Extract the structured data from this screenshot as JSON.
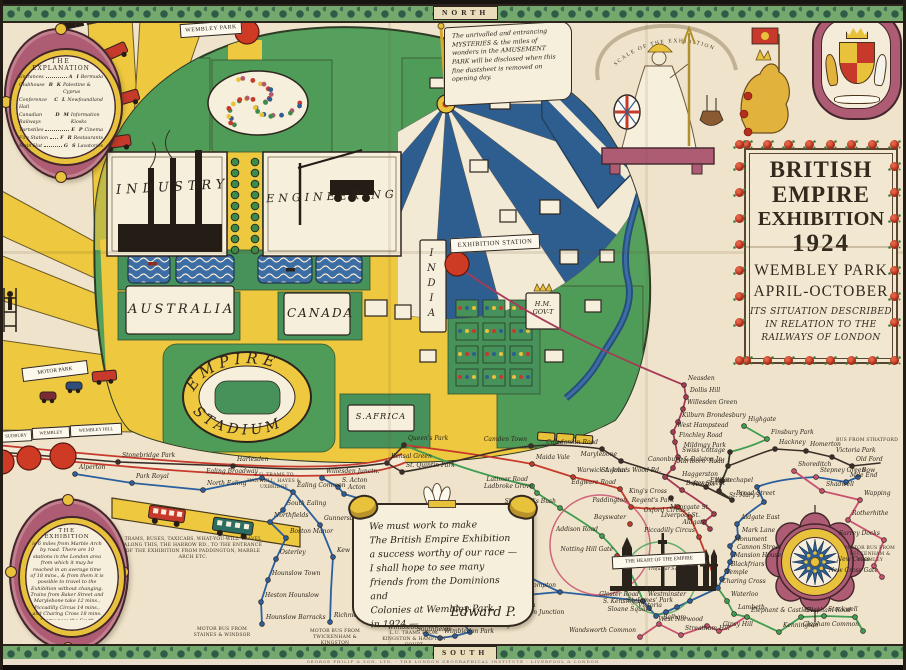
{
  "frame": {
    "north": "NORTH",
    "south": "SOUTH",
    "imprint": "GEORGE PHILIP & SON, LTD. - THE LONDON GEOGRAPHICAL INSTITUTE - LIVERPOOL & LONDON"
  },
  "title_panel": {
    "lines": [
      "BRITISH",
      "EMPIRE",
      "EXHIBITION",
      "1924",
      "WEMBLEY PARK",
      "APRIL-OCTOBER",
      "ITS SITUATION DESCRIBED",
      "IN RELATION TO THE",
      "RAILWAYS OF LONDON"
    ]
  },
  "legend": {
    "title_line1": "THE",
    "title_line2": "EXPLANATION",
    "left": [
      {
        "label": "Entrances",
        "key": "A"
      },
      {
        "label": "Clubhouse",
        "key": "B"
      },
      {
        "label": "Conference Hall",
        "key": "C"
      },
      {
        "label": "Canadian Railways",
        "key": "D"
      },
      {
        "label": "Turnstiles",
        "key": "E"
      },
      {
        "label": "Fire Station",
        "key": "F"
      },
      {
        "label": "Main Hut",
        "key": "G"
      },
      {
        "label": "Bank",
        "key": "H"
      }
    ],
    "right": [
      {
        "key": "I",
        "label": "Bermuda"
      },
      {
        "key": "K",
        "label": "Palestine & Cyprus"
      },
      {
        "key": "L",
        "label": "Newfoundland"
      },
      {
        "key": "M",
        "label": "Information Kiosks"
      },
      {
        "key": "P",
        "label": "Cinema"
      },
      {
        "key": "R",
        "label": "Restaurants"
      },
      {
        "key": "S",
        "label": "Lavatories"
      },
      {
        "key": "T",
        "label": "Sierra Leone"
      }
    ]
  },
  "park": {
    "wembley_park_banner": "WEMBLEY PARK",
    "industry": "INDUSTRY",
    "engineering": "ENGINEERING",
    "australia": "AUSTRALIA",
    "canada": "CANADA",
    "india": "INDIA",
    "s_africa": "S.AFRICA",
    "hm_govt_1": "H.M.",
    "hm_govt_2": "GOV-T",
    "stadium_top": "EMPIRE",
    "stadium_bottom": "STADIUM",
    "exhibition_station_banner": "EXHIBITION STATION"
  },
  "banners": {
    "scale_ribbon": "SCALE OF THE EXHIBITION",
    "motor_park": "MOTOR PARK",
    "sudbury": "SUDBURY",
    "wembley": "WEMBLEY",
    "wembley_hill": "WEMBLEY HILL",
    "heart_of_empire": "THE HEART OF THE EMPIRE",
    "trafalgar": "Trafalgar Square"
  },
  "scroll_amusement": "The unrivalled and entrancing MYSTERIES & the miles of wonders in the AMUSEMENT PARK will be disclosed when this fine dustsheet is removed on opening day.",
  "scroll_king": {
    "lines": [
      "We must work to make",
      "The British Empire Exhibition",
      "a success worthy of our race —",
      "I shall hope to see many",
      "friends from the Dominions and",
      "Colonies at Wembley Park",
      "in 1924 —"
    ],
    "signature": "Edward P."
  },
  "cartouche_exhibition": {
    "title_line1": "THE",
    "title_line2": "EXHIBITION",
    "text": "is 6 miles from Marble Arch by road. There are 10 stations in the London area from which it may be reached in an average time of 18 mins., & from them it is possible to travel to the Exhibition without changing. Trains from Baker Street and Marylebone take 12 mins., Piccadilly Circus 14 mins., and Charing Cross 18 mins. Trams pass the South Entrance from Paddington, Willesden, Hammersmith, Putney, Acton &c. Omnibus services run to all the entrances."
  },
  "notes": [
    {
      "t": "L.U. TRAMS TO HANWELL, HAYES & UXBRIDGE",
      "x": 243,
      "y": 473,
      "w": 62
    },
    {
      "t": "TRAMS, BUSES, TAXICABS, WHAT-YOU-WILL TRAVEL ALONG THIS, THE HARROW RD., TO THE ENTRANCE OF THE EXHIBITION FROM PADDINGTON, MARBLE ARCH ETC.",
      "x": 122,
      "y": 537,
      "w": 142
    },
    {
      "t": "MOTOR BUS FROM STAINES & WINDSOR",
      "x": 192,
      "y": 627,
      "w": 60
    },
    {
      "t": "MOTOR BUS FROM TWICKENHAM & KINGSTON",
      "x": 303,
      "y": 629,
      "w": 64
    },
    {
      "t": "L.U. TRAMS FROM KINGSTON & HAMPTON COURT",
      "x": 380,
      "y": 631,
      "w": 68
    },
    {
      "t": "MOTOR BUS FROM BECKENHAM & BROMLEY",
      "x": 840,
      "y": 546,
      "w": 60
    },
    {
      "t": "BUS FROM STRATFORD",
      "x": 836,
      "y": 438,
      "w": 62
    }
  ],
  "stations": [
    {
      "n": "Alperton",
      "x": 75,
      "y": 474,
      "c": "blue"
    },
    {
      "n": "Park Royal",
      "x": 132,
      "y": 483,
      "c": "blue"
    },
    {
      "n": "North Ealing",
      "x": 203,
      "y": 490,
      "c": "blue"
    },
    {
      "n": "Ealing Broadway",
      "x": 262,
      "y": 478,
      "c": "blue",
      "a": "e"
    },
    {
      "n": "Ealing Common",
      "x": 293,
      "y": 492,
      "c": "blue"
    },
    {
      "n": "South Ealing",
      "x": 283,
      "y": 510,
      "c": "blue"
    },
    {
      "n": "Northfields",
      "x": 270,
      "y": 522,
      "c": "blue"
    },
    {
      "n": "Boston Manor",
      "x": 286,
      "y": 538,
      "c": "blue"
    },
    {
      "n": "Osterley",
      "x": 276,
      "y": 559,
      "c": "blue"
    },
    {
      "n": "Hounslow Town",
      "x": 268,
      "y": 580,
      "c": "blue"
    },
    {
      "n": "Heston Hounslow",
      "x": 261,
      "y": 602,
      "c": "blue"
    },
    {
      "n": "Hounslow Barracks",
      "x": 262,
      "y": 624,
      "c": "blue"
    },
    {
      "n": "Gunnersbury",
      "x": 320,
      "y": 525,
      "c": "blue"
    },
    {
      "n": "Kew Gardens",
      "x": 333,
      "y": 557,
      "c": "blue"
    },
    {
      "n": "Richmond",
      "x": 330,
      "y": 622,
      "c": "blue"
    },
    {
      "n": "Willesden Junctn.",
      "x": 322,
      "y": 478,
      "c": "blue"
    },
    {
      "n": "S. Acton",
      "x": 338,
      "y": 487,
      "c": "blue"
    },
    {
      "n": "Acton",
      "x": 344,
      "y": 494,
      "c": "blue"
    },
    {
      "n": "Stonebridge Park",
      "x": 118,
      "y": 462,
      "c": "dark"
    },
    {
      "n": "Harlesden",
      "x": 233,
      "y": 466,
      "c": "dark"
    },
    {
      "n": "Kensal Green",
      "x": 387,
      "y": 463,
      "c": "dark"
    },
    {
      "n": "Queen's Park",
      "x": 404,
      "y": 445,
      "c": "dark"
    },
    {
      "n": "St. Quintin Park",
      "x": 402,
      "y": 472,
      "c": "dark"
    },
    {
      "n": "Maida Vale",
      "x": 532,
      "y": 464,
      "c": "red"
    },
    {
      "n": "Warwick Avenue",
      "x": 573,
      "y": 477,
      "c": "red"
    },
    {
      "n": "Paddington",
      "x": 631,
      "y": 507,
      "c": "red",
      "a": "e"
    },
    {
      "n": "Edgware Road",
      "x": 620,
      "y": 489,
      "c": "red",
      "a": "e"
    },
    {
      "n": "Marylebone",
      "x": 621,
      "y": 461,
      "c": "dark",
      "a": "e"
    },
    {
      "n": "Caledonian Road",
      "x": 602,
      "y": 449,
      "c": "dark",
      "a": "e"
    },
    {
      "n": "Camden Town",
      "x": 531,
      "y": 446,
      "c": "dark",
      "a": "e"
    },
    {
      "n": "Latimer Road",
      "x": 532,
      "y": 486,
      "c": "green",
      "a": "e"
    },
    {
      "n": "Ladbroke Grove",
      "x": 537,
      "y": 493,
      "c": "green",
      "a": "e"
    },
    {
      "n": "Shepherd's Bush",
      "x": 560,
      "y": 508,
      "c": "green",
      "a": "e"
    },
    {
      "n": "Addison Road",
      "x": 602,
      "y": 536,
      "c": "green",
      "a": "e"
    },
    {
      "n": "Notting Hill Gate",
      "x": 617,
      "y": 556,
      "c": "red",
      "a": "e"
    },
    {
      "n": "Bayswater",
      "x": 630,
      "y": 524,
      "c": "red",
      "a": "e"
    },
    {
      "n": "Neasden",
      "x": 684,
      "y": 385,
      "c": "maroon"
    },
    {
      "n": "Dollis Hill",
      "x": 686,
      "y": 397,
      "c": "maroon"
    },
    {
      "n": "Willesden Green",
      "x": 683,
      "y": 409,
      "c": "maroon"
    },
    {
      "n": "Kilburn Brondesbury",
      "x": 678,
      "y": 422,
      "c": "maroon"
    },
    {
      "n": "West Hampstead",
      "x": 673,
      "y": 432,
      "c": "maroon"
    },
    {
      "n": "Finchley Road",
      "x": 675,
      "y": 442,
      "c": "maroon"
    },
    {
      "n": "Swiss Cottage",
      "x": 678,
      "y": 457,
      "c": "maroon"
    },
    {
      "n": "Marlboro' Road",
      "x": 673,
      "y": 468,
      "c": "maroon"
    },
    {
      "n": "St. John's Wood Rd.",
      "x": 665,
      "y": 477,
      "c": "maroon",
      "a": "e"
    },
    {
      "n": "Baker Street",
      "x": 682,
      "y": 490,
      "c": "maroon"
    },
    {
      "n": "King's Cross",
      "x": 671,
      "y": 498,
      "c": "dark",
      "a": "e"
    },
    {
      "n": "Euston",
      "x": 706,
      "y": 487,
      "c": "dark"
    },
    {
      "n": "Regent's Park",
      "x": 678,
      "y": 507,
      "c": "red",
      "a": "e"
    },
    {
      "n": "Oxford Circus",
      "x": 690,
      "y": 517,
      "c": "red",
      "a": "e"
    },
    {
      "n": "Piccadilly Circus",
      "x": 699,
      "y": 537,
      "c": "red",
      "a": "e"
    },
    {
      "n": "Highgate",
      "x": 744,
      "y": 426,
      "c": "green"
    },
    {
      "n": "Finsbury Park",
      "x": 767,
      "y": 439,
      "c": "green"
    },
    {
      "n": "Mildmay Park",
      "x": 730,
      "y": 452,
      "c": "dark",
      "a": "e"
    },
    {
      "n": "Canonbury & Dalston Jn.",
      "x": 728,
      "y": 466,
      "c": "dark",
      "a": "e"
    },
    {
      "n": "Hackney",
      "x": 775,
      "y": 449,
      "c": "dark"
    },
    {
      "n": "Homerton",
      "x": 806,
      "y": 451,
      "c": "dark"
    },
    {
      "n": "Victoria Park",
      "x": 832,
      "y": 457,
      "c": "dark"
    },
    {
      "n": "Old Ford",
      "x": 852,
      "y": 466,
      "c": "dark"
    },
    {
      "n": "Haggerston",
      "x": 722,
      "y": 481,
      "c": "dark",
      "a": "e"
    },
    {
      "n": "Hoxton",
      "x": 719,
      "y": 491,
      "c": "dark",
      "a": "e"
    },
    {
      "n": "Broad Street",
      "x": 732,
      "y": 500,
      "c": "dark"
    },
    {
      "n": "Shoreditch",
      "x": 794,
      "y": 471,
      "c": "pink"
    },
    {
      "n": "Stepney Green",
      "x": 816,
      "y": 477,
      "c": "pink"
    },
    {
      "n": "Mile End",
      "x": 846,
      "y": 482,
      "c": "blue"
    },
    {
      "n": "Bow",
      "x": 858,
      "y": 477,
      "c": "blue"
    },
    {
      "n": "Whitechapel",
      "x": 757,
      "y": 487,
      "c": "blue",
      "a": "e"
    },
    {
      "n": "St. Mary's",
      "x": 764,
      "y": 502,
      "c": "blue",
      "a": "e"
    },
    {
      "n": "Aldgate East",
      "x": 737,
      "y": 524,
      "c": "blue"
    },
    {
      "n": "Aldgate",
      "x": 710,
      "y": 529,
      "c": "maroon",
      "a": "e"
    },
    {
      "n": "Liverpool St.",
      "x": 704,
      "y": 522,
      "c": "maroon",
      "a": "e"
    },
    {
      "n": "Moorgate St.",
      "x": 714,
      "y": 514,
      "c": "maroon",
      "a": "e"
    },
    {
      "n": "Mark Lane",
      "x": 738,
      "y": 537,
      "c": "blue"
    },
    {
      "n": "Monument",
      "x": 730,
      "y": 546,
      "c": "blue"
    },
    {
      "n": "Cannon Street",
      "x": 733,
      "y": 554,
      "c": "blue"
    },
    {
      "n": "Mansion House",
      "x": 730,
      "y": 562,
      "c": "blue"
    },
    {
      "n": "Blackfriars",
      "x": 727,
      "y": 571,
      "c": "blue"
    },
    {
      "n": "Temple",
      "x": 722,
      "y": 579,
      "c": "blue"
    },
    {
      "n": "Charing Cross",
      "x": 718,
      "y": 588,
      "c": "blue"
    },
    {
      "n": "Westminster",
      "x": 690,
      "y": 601,
      "c": "blue",
      "a": "e"
    },
    {
      "n": "St. James' Park",
      "x": 677,
      "y": 607,
      "c": "blue",
      "a": "e"
    },
    {
      "n": "Victoria",
      "x": 666,
      "y": 612,
      "c": "blue",
      "a": "e"
    },
    {
      "n": "Sloane Square",
      "x": 656,
      "y": 616,
      "c": "blue",
      "a": "e"
    },
    {
      "n": "S. Kensington",
      "x": 649,
      "y": 608,
      "c": "blue",
      "a": "e"
    },
    {
      "n": "Gloster Road",
      "x": 643,
      "y": 601,
      "c": "blue",
      "a": "e"
    },
    {
      "n": "West Brompton",
      "x": 560,
      "y": 592,
      "c": "blue",
      "a": "e"
    },
    {
      "n": "Walham Green",
      "x": 444,
      "y": 609,
      "c": "blue",
      "a": "e"
    },
    {
      "n": "Parsons Green",
      "x": 452,
      "y": 614,
      "c": "blue"
    },
    {
      "n": "Putney Bridge",
      "x": 462,
      "y": 622,
      "c": "blue"
    },
    {
      "n": "East Putney",
      "x": 470,
      "y": 632,
      "c": "blue"
    },
    {
      "n": "Southfields",
      "x": 455,
      "y": 636,
      "c": "blue",
      "a": "e"
    },
    {
      "n": "Wimbledon Park",
      "x": 440,
      "y": 638,
      "c": "blue"
    },
    {
      "n": "Wimbledon",
      "x": 426,
      "y": 634,
      "c": "blue",
      "a": "e"
    },
    {
      "n": "Clapham Junction",
      "x": 506,
      "y": 619,
      "c": "pink"
    },
    {
      "n": "Battersea",
      "x": 502,
      "y": 612,
      "c": "pink"
    },
    {
      "n": "Waterloo",
      "x": 727,
      "y": 601,
      "c": "green"
    },
    {
      "n": "Lambeth",
      "x": 734,
      "y": 614,
      "c": "green"
    },
    {
      "n": "Elephant & Castle",
      "x": 747,
      "y": 617,
      "c": "green"
    },
    {
      "n": "Kennington",
      "x": 779,
      "y": 632,
      "c": "green"
    },
    {
      "n": "Oval",
      "x": 801,
      "y": 617,
      "c": "green"
    },
    {
      "n": "Stockwell",
      "x": 824,
      "y": 616,
      "c": "green"
    },
    {
      "n": "Clapham Road",
      "x": 855,
      "y": 617,
      "c": "green",
      "a": "e"
    },
    {
      "n": "Clapham Common",
      "x": 863,
      "y": 631,
      "c": "green",
      "a": "e"
    },
    {
      "n": "Balham",
      "x": 659,
      "y": 624,
      "c": "pink"
    },
    {
      "n": "Wandsworth Common",
      "x": 640,
      "y": 637,
      "c": "pink",
      "a": "e"
    },
    {
      "n": "Streatham Hill",
      "x": 681,
      "y": 635,
      "c": "pink"
    },
    {
      "n": "West Nor­wood",
      "x": 707,
      "y": 626,
      "c": "pink",
      "a": "e"
    },
    {
      "n": "Gipsy Hill",
      "x": 719,
      "y": 631,
      "c": "pink"
    },
    {
      "n": "Shadwell",
      "x": 822,
      "y": 491,
      "c": "pink"
    },
    {
      "n": "Wapping",
      "x": 860,
      "y": 500,
      "c": "pink"
    },
    {
      "n": "Rotherhithe",
      "x": 848,
      "y": 520,
      "c": "pink"
    },
    {
      "n": "Surrey Docks",
      "x": 884,
      "y": 540,
      "c": "pink",
      "a": "e"
    },
    {
      "n": "New Cross",
      "x": 874,
      "y": 566,
      "c": "pink",
      "a": "e"
    },
    {
      "n": "New Cross Gate",
      "x": 882,
      "y": 577,
      "c": "pink",
      "a": "e"
    }
  ],
  "colors": {
    "blue": "#2b5f9e",
    "green": "#3f9e52",
    "dark": "#3a2f28",
    "maroon": "#a83a56",
    "red": "#c6392b",
    "pink": "#c9506e"
  }
}
